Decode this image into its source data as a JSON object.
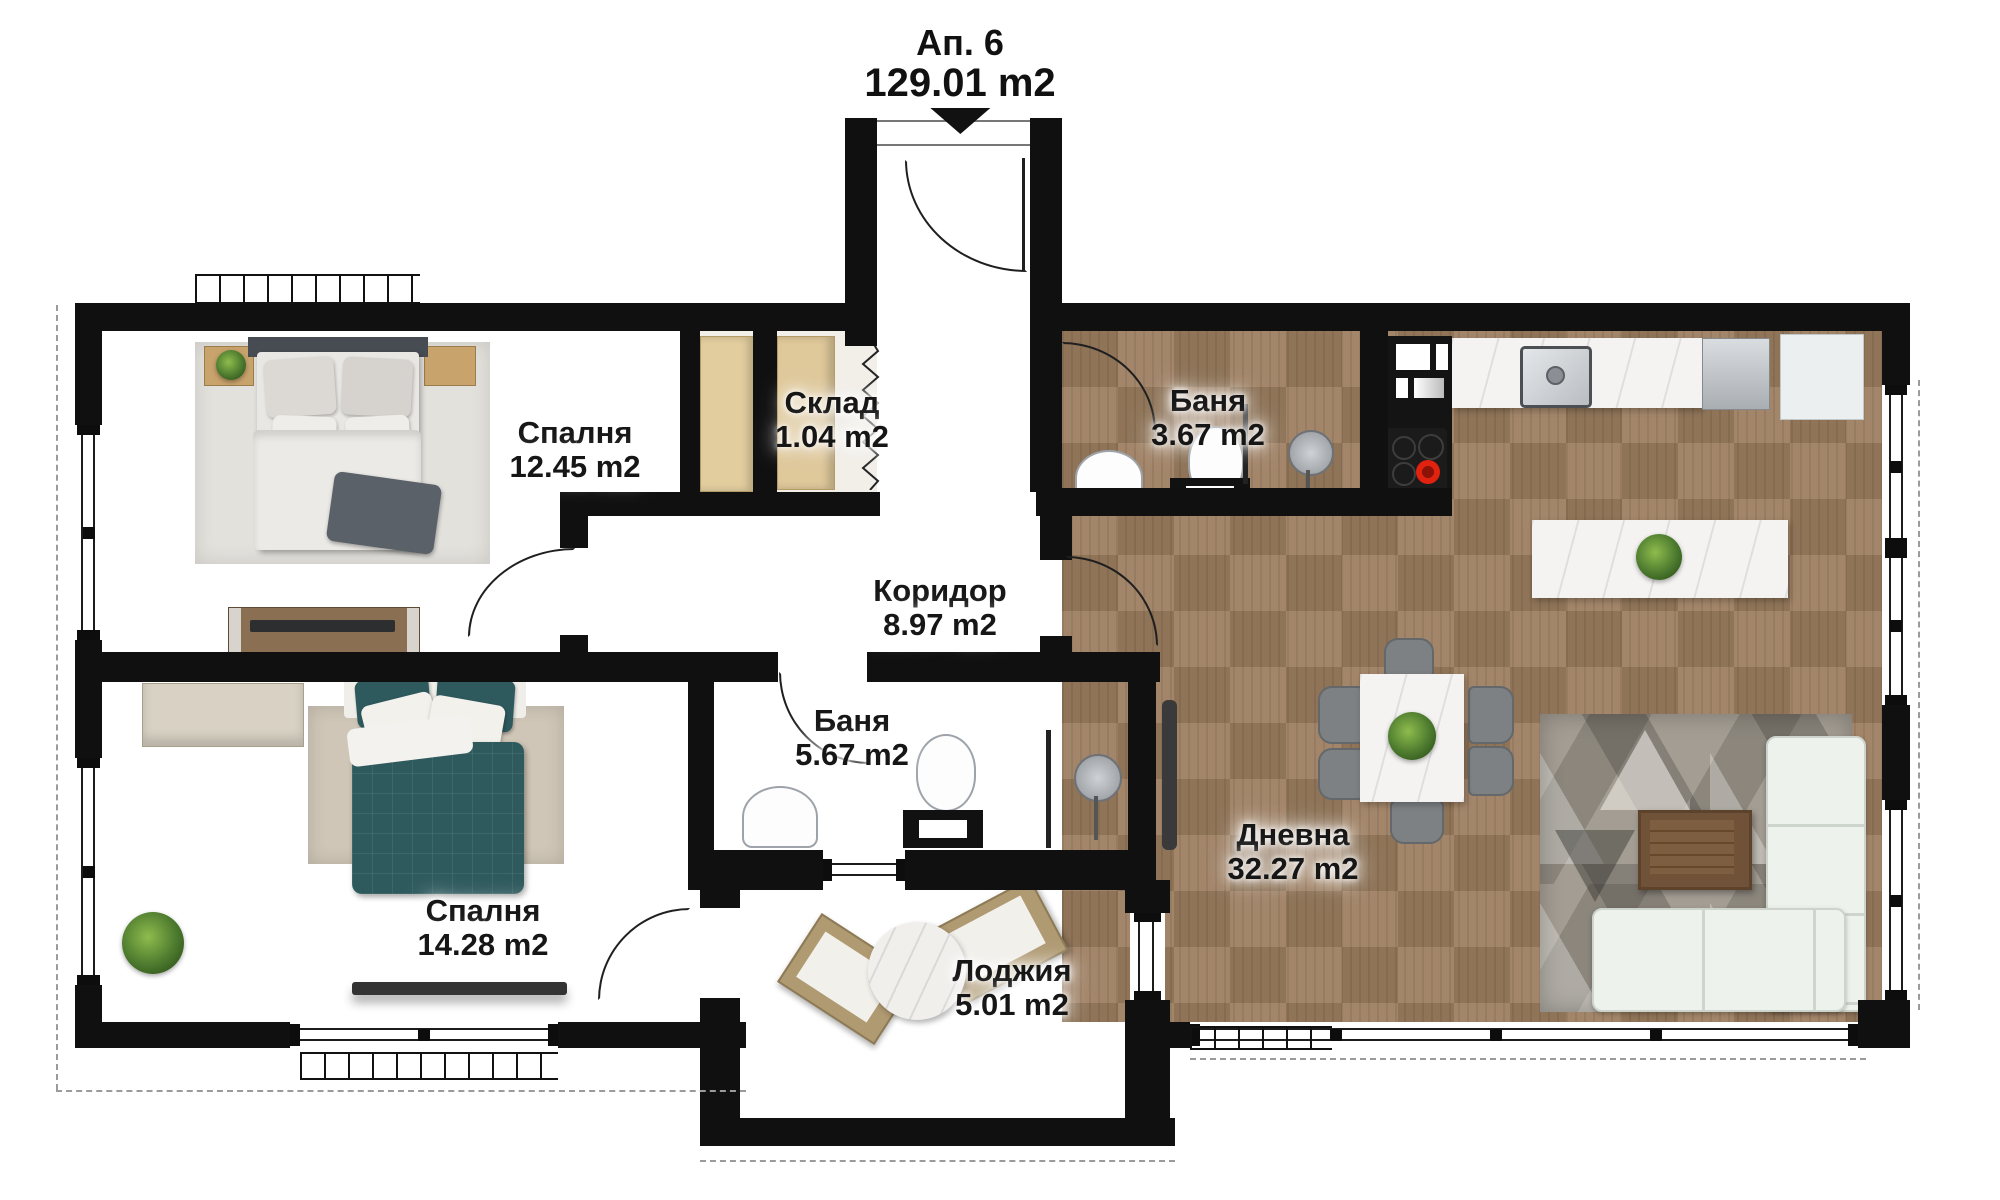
{
  "header": {
    "apartment": "Ап. 6",
    "total_area": "129.01 m2"
  },
  "rooms": {
    "bedroom1": {
      "name": "Спалня",
      "area": "12.45 m2"
    },
    "storage": {
      "name": "Склад",
      "area": "1.04 m2"
    },
    "bath1": {
      "name": "Баня",
      "area": "3.67 m2"
    },
    "corridor": {
      "name": "Коридор",
      "area": "8.97 m2"
    },
    "bath2": {
      "name": "Баня",
      "area": "5.67 m2"
    },
    "bedroom2": {
      "name": "Спалня",
      "area": "14.28 m2"
    },
    "loggia": {
      "name": "Лоджия",
      "area": "5.01 m2"
    },
    "living": {
      "name": "Дневна",
      "area": "32.27 m2"
    }
  },
  "icons": {
    "entrance_arrow": "entrance direction marker"
  },
  "colors": {
    "wall": "#101010",
    "wood_dark": "#6b5640",
    "parquet": "#9c8062",
    "travertine": "#d9ccb8",
    "marble": "#f3f2f0",
    "loggia_tile": "#d4d4d2",
    "accent_teal": "#2e5a5e",
    "sofa": "#edf2ec",
    "cabinet_beige": "#e2cd9e",
    "label_text": "#161616"
  }
}
